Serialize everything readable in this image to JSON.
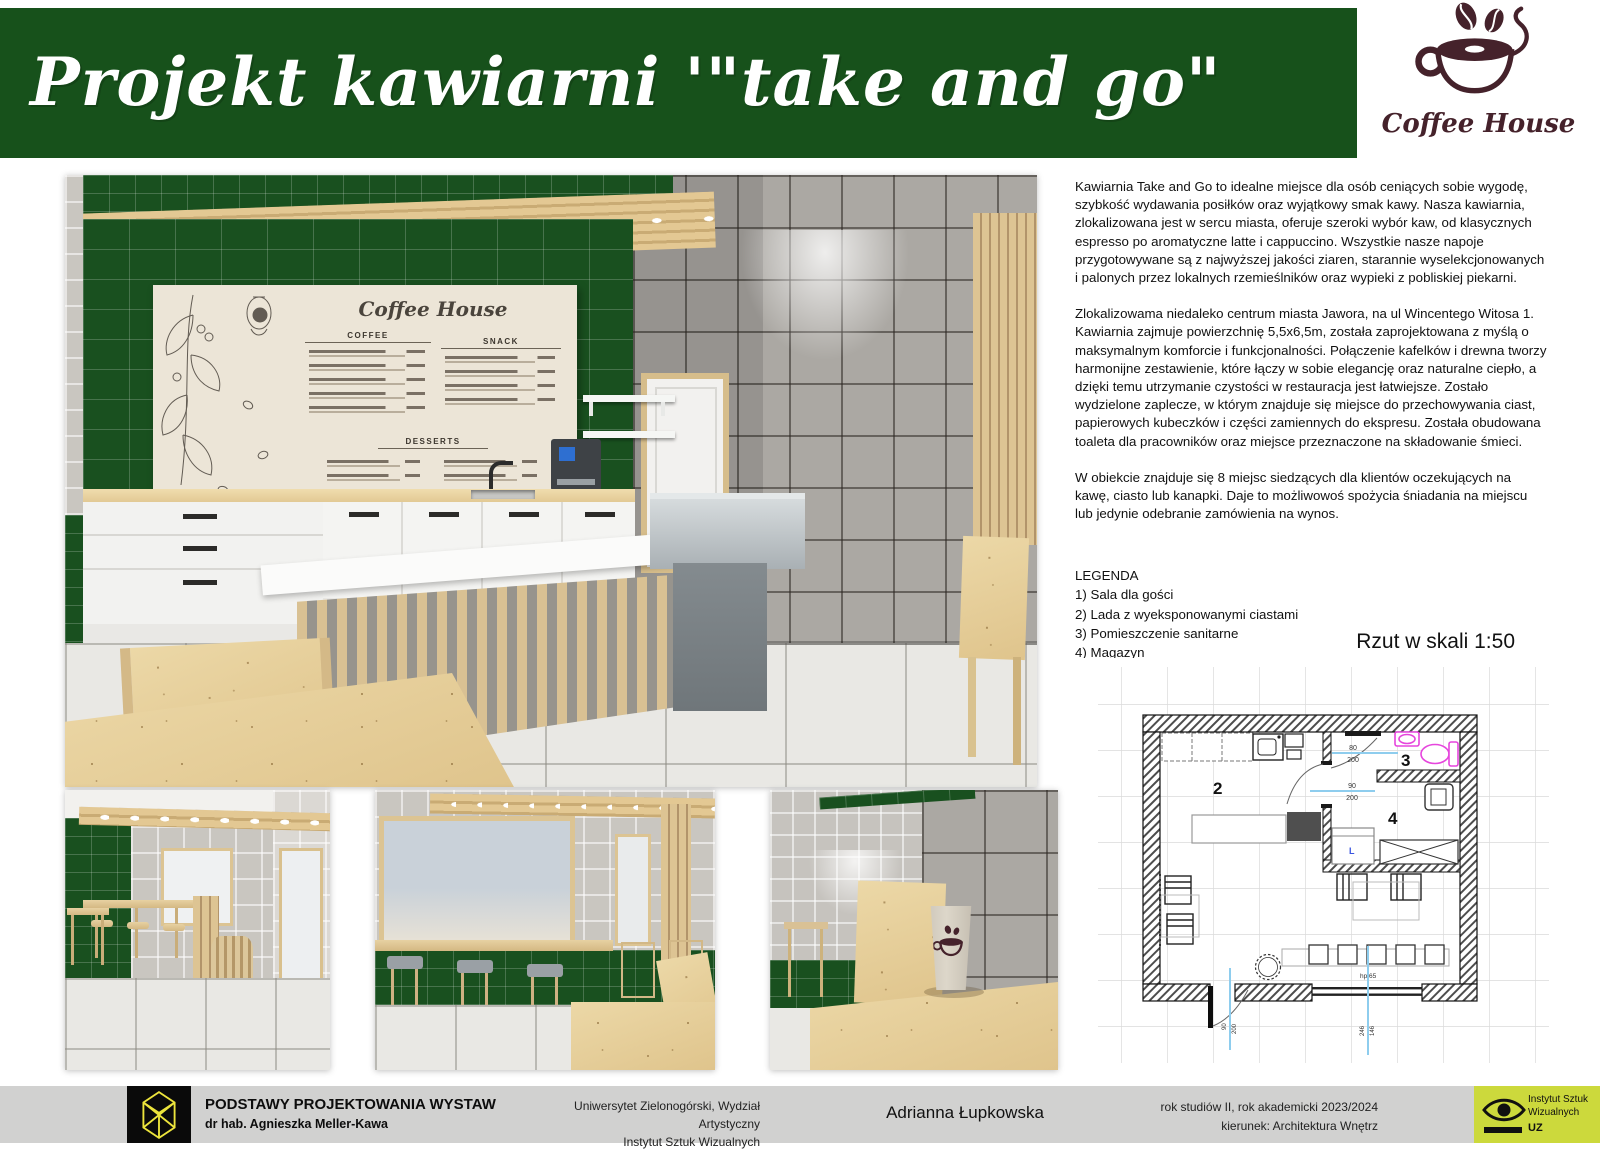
{
  "header": {
    "title": "Projekt kawiarni '\"take and go\"",
    "logo_text": "Coffee House"
  },
  "menu_board": {
    "title": "Coffee House",
    "sections": [
      "COFFEE",
      "SNACK",
      "DESSERTS"
    ]
  },
  "description": {
    "para1": "Kawiarnia Take and Go to idealne miejsce dla osób ceniących sobie wygodę, szybkość wydawania posiłków oraz wyjątkowy smak kawy. Nasza kawiarnia, zlokalizowana jest w sercu miasta, oferuje szeroki wybór kaw, od klasycznych espresso po aromatyczne latte i cappuccino. Wszystkie nasze napoje przygotowywane są z najwyższej jakości ziaren, starannie wyselekcjonowanych i palonych przez lokalnych rzemieślników oraz wypieki z pobliskiej piekarni.",
    "para2": "Zlokalizowama niedaleko centrum miasta Jawora, na ul Wincentego Witosa 1. Kawiarnia zajmuje powierzchnię 5,5x6,5m, została zaprojektowana z myślą o maksymalnym komforcie i funkcjonalności. Połączenie kafelków i drewna tworzy harmonijne zestawienie, które łączy w sobie elegancję oraz naturalne ciepło, a dzięki temu utrzymanie czystości w restauracja jest łatwiejsze. Zostało wydzielone zaplecze, w którym znajduje się miejsce do przechowywania ciast, papierowych kubeczków i części zamiennych do ekspresu. Została obudowana toaleta dla pracowników oraz miejsce przeznaczone na składowanie śmieci.",
    "para3": "W obiekcie znajduje się 8 miejsc siedzących dla klientów oczekujących na kawę, ciasto lub kanapki. Daje to możliwowoś spożycia śniadania na miejscu lub jedynie odebranie zamówienia na wynos."
  },
  "legend": {
    "title": "LEGENDA",
    "items": [
      "1) Sala dla gości",
      "2) Lada z wyeksponowanymi ciastami",
      "3) Pomieszczenie sanitarne",
      "4) Magazyn"
    ]
  },
  "plan": {
    "title": "Rzut w skali 1:50",
    "rooms": {
      "r2": "2",
      "r3": "3",
      "r4": "4"
    },
    "dims": {
      "wc_door_w": "80",
      "wc_door_h": "200",
      "mag_door_w": "90",
      "mag_door_h": "200",
      "entry_w": "90",
      "entry_h": "200",
      "win_a": "246",
      "win_b": "146",
      "bench": "hp 65",
      "fridge": "L"
    }
  },
  "footer": {
    "course": "PODSTAWY PROJEKTOWANIA WYSTAW",
    "lecturer": "dr hab. Agnieszka Meller-Kawa",
    "uni1": "Uniwersytet Zielonogórski, Wydział Artystyczny",
    "uni2": "Instytut Sztuk Wizualnych",
    "author": "Adrianna Łupkowska",
    "year": "rok studiów II, rok akademicki 2023/2024",
    "field": "kierunek: Architektura Wnętrz",
    "badge1": "Instytut Sztuk",
    "badge2": "Wizualnych",
    "badge3": "UZ"
  },
  "colors": {
    "banner_green": "#17511b",
    "tile_green": "#19501f",
    "logo_brown": "#45222b",
    "footer_gray": "#d1d1d0",
    "badge_chartreuse": "#ccd93c",
    "plan_dim_blue": "#8ecdee",
    "plan_fixture_pink": "#e645dd"
  }
}
